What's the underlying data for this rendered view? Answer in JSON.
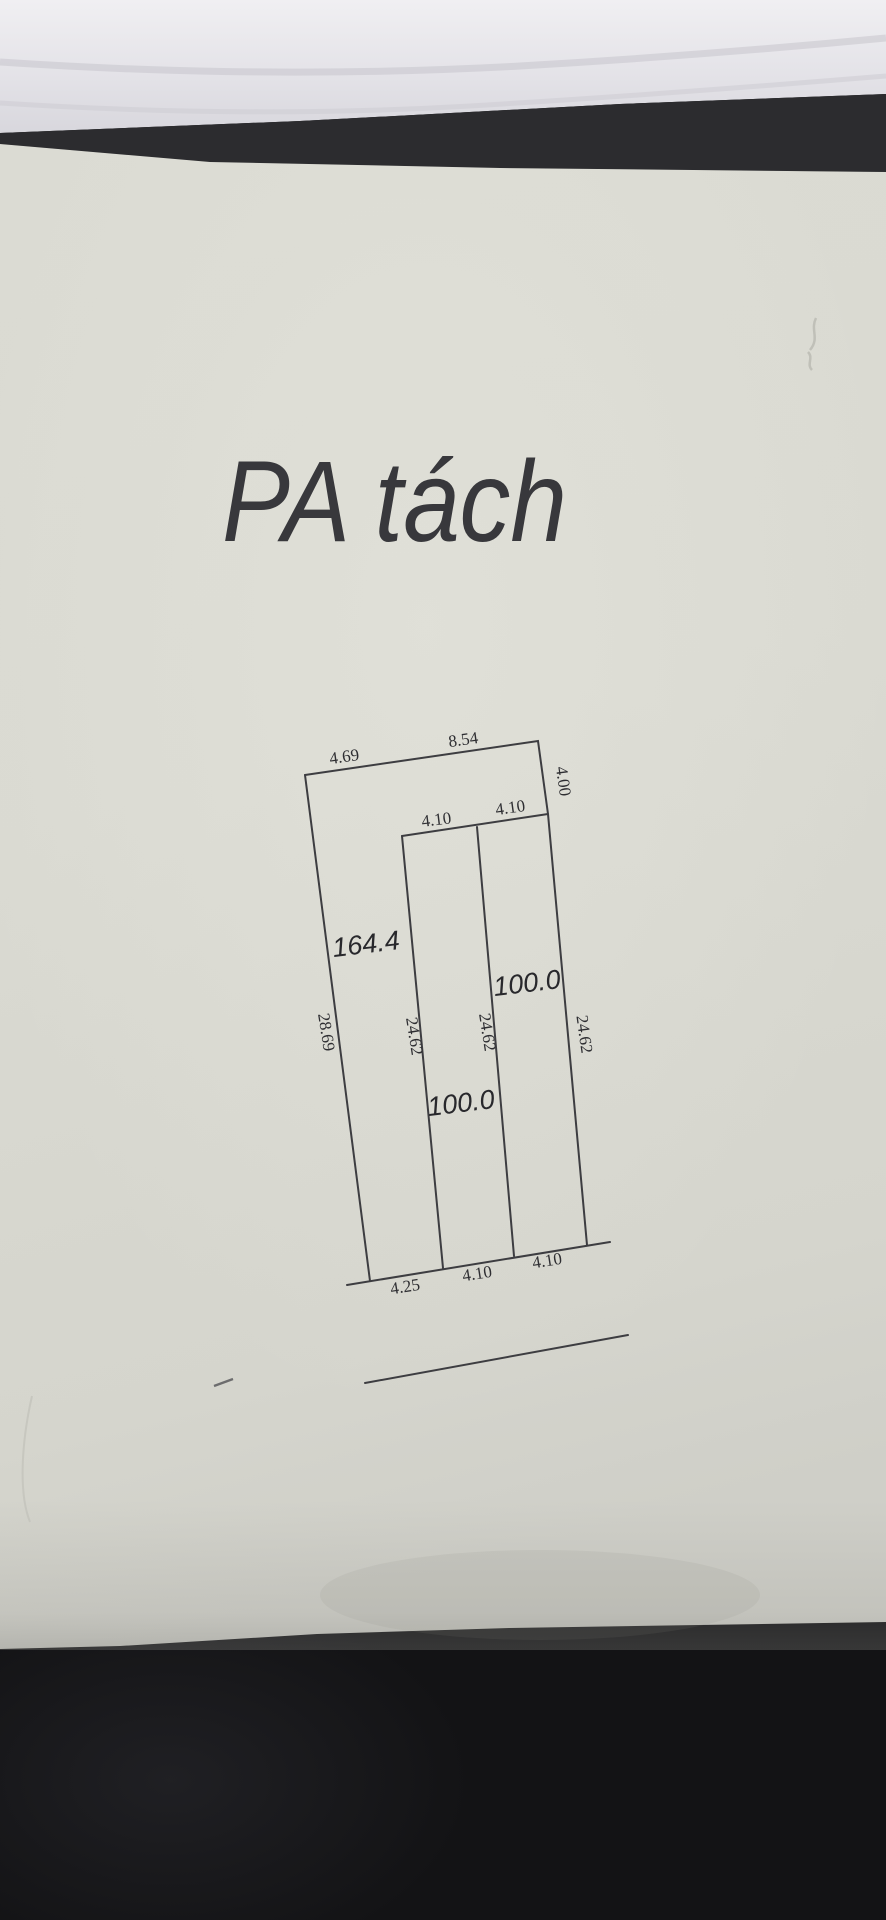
{
  "drawing": {
    "title": "PA tách",
    "dims": {
      "top_left": "4.69",
      "top_right": "8.54",
      "right_upper": "4.00",
      "notch_left": "4.10",
      "notch_right": "4.10",
      "side_left": "28.69",
      "divider_left": "24.62",
      "divider_mid": "24.62",
      "side_right": "24.62",
      "bottom_left": "4.25",
      "bottom_mid": "4.10",
      "bottom_right": "4.10"
    },
    "areas": {
      "plot_left": "164.4",
      "plot_right": "100.0",
      "plot_mid": "100.0"
    }
  }
}
